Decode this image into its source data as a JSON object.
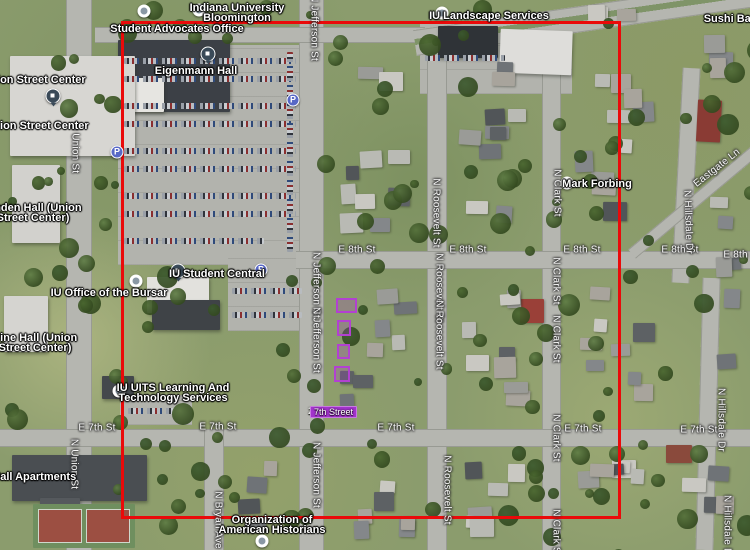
{
  "map": {
    "boundary": {
      "color": "#ea0a0a",
      "left": 121,
      "top": 21,
      "width": 500,
      "height": 498
    },
    "selection": {
      "color": "#b241d1",
      "parcels": [
        {
          "x": 336,
          "y": 298,
          "w": 21,
          "h": 15
        },
        {
          "x": 337,
          "y": 320,
          "w": 14,
          "h": 16
        },
        {
          "x": 337,
          "y": 344,
          "w": 13,
          "h": 15
        },
        {
          "x": 334,
          "y": 366,
          "w": 16,
          "h": 16
        }
      ],
      "label": {
        "prefix": "230",
        "text": "7th Street",
        "x": 308,
        "y": 406
      }
    },
    "parking_icons": [
      {
        "x": 293,
        "y": 100
      },
      {
        "x": 117,
        "y": 152
      },
      {
        "x": 261,
        "y": 270
      }
    ],
    "pois": [
      {
        "name": "indiana-university-bloomington",
        "lines": [
          "Indiana University",
          "Bloomington"
        ],
        "x": 237,
        "y": 3,
        "pin": {
          "x": 199,
          "y": 10,
          "type": "poi"
        }
      },
      {
        "name": "student-advocates-office",
        "lines": [
          "Student Advocates Office"
        ],
        "x": 177,
        "y": 24,
        "pin": {
          "x": 144,
          "y": 11,
          "type": "poi"
        }
      },
      {
        "name": "eigenmann-hall",
        "lines": [
          "Eigenmann Hall"
        ],
        "x": 196,
        "y": 66,
        "pin": {
          "x": 208,
          "y": 54,
          "type": "navy"
        }
      },
      {
        "name": "iu-landscape-services",
        "lines": [
          "IU Landscape Services"
        ],
        "x": 489,
        "y": 11,
        "pin": {
          "x": 442,
          "y": 13,
          "type": "poi"
        }
      },
      {
        "name": "sushi-bar-bloomington",
        "lines": [
          "Sushi Bar Bloom"
        ],
        "x": 748,
        "y": 14
      },
      {
        "name": "union-street-center-north",
        "lines": [
          "Union Street Center"
        ],
        "x": 34,
        "y": 75,
        "pin": {
          "x": 53,
          "y": 96,
          "type": "navy"
        }
      },
      {
        "name": "union-street-center-south",
        "lines": [
          "Union Street Center"
        ],
        "x": 37,
        "y": 121
      },
      {
        "name": "linden-hall-union-street-center",
        "lines": [
          "Linden Hall (Union",
          "Street Center)"
        ],
        "x": 33,
        "y": 203
      },
      {
        "name": "iu-office-of-the-bursar",
        "lines": [
          "IU Office of the Bursar"
        ],
        "x": 109,
        "y": 288,
        "pin": {
          "x": 136,
          "y": 281,
          "type": "poi"
        }
      },
      {
        "name": "pine-hall-union-street-center",
        "lines": [
          "Pine Hall (Union",
          "Street Center)"
        ],
        "x": 35,
        "y": 333
      },
      {
        "name": "iu-student-central",
        "lines": [
          "IU Student Central"
        ],
        "x": 217,
        "y": 269,
        "pin": {
          "x": 178,
          "y": 271,
          "type": "navy"
        }
      },
      {
        "name": "mark-forbing",
        "lines": [
          "Mark Forbing"
        ],
        "x": 597,
        "y": 179,
        "pin": {
          "x": 567,
          "y": 183,
          "type": "poi"
        }
      },
      {
        "name": "iu-uits-learning-and-technology-services",
        "lines": [
          "IU UITS Learning And",
          "Technology Services"
        ],
        "x": 173,
        "y": 383,
        "pin": {
          "x": 119,
          "y": 391,
          "type": "poi"
        }
      },
      {
        "name": "organization-of-american-historians",
        "lines": [
          "Organization of",
          "American Historians"
        ],
        "x": 272,
        "y": 515,
        "pin": {
          "x": 262,
          "y": 541,
          "type": "poi"
        }
      },
      {
        "name": "hall-apartments",
        "lines": [
          "on Hall Apartments"
        ],
        "x": 26,
        "y": 472
      }
    ],
    "streets": [
      {
        "label": "E 8th St",
        "x": 357,
        "y": 250,
        "rot": 0
      },
      {
        "label": "E 8th St",
        "x": 468,
        "y": 250,
        "rot": 0
      },
      {
        "label": "E 8th St",
        "x": 582,
        "y": 250,
        "rot": 0
      },
      {
        "label": "E 8th St",
        "x": 680,
        "y": 250,
        "rot": 0
      },
      {
        "label": "E 8th St",
        "x": 742,
        "y": 255,
        "rot": 0
      },
      {
        "label": "E 7th St",
        "x": 97,
        "y": 428,
        "rot": 0
      },
      {
        "label": "E 7th St",
        "x": 218,
        "y": 427,
        "rot": 0
      },
      {
        "label": "E 7th St",
        "x": 396,
        "y": 428,
        "rot": 0
      },
      {
        "label": "E 7th St",
        "x": 583,
        "y": 429,
        "rot": 0
      },
      {
        "label": "E 7th St",
        "x": 699,
        "y": 430,
        "rot": 0
      },
      {
        "label": "N Union St",
        "x": 75,
        "y": 148,
        "rot": 90
      },
      {
        "label": "N Union St",
        "x": 74,
        "y": 464,
        "rot": 90
      },
      {
        "label": "N Jefferson St",
        "x": 314,
        "y": 28,
        "rot": 90
      },
      {
        "label": "N Jefferson St",
        "x": 316,
        "y": 285,
        "rot": 90
      },
      {
        "label": "N Jefferson St",
        "x": 316,
        "y": 340,
        "rot": 90
      },
      {
        "label": "N Jefferson St",
        "x": 316,
        "y": 475,
        "rot": 90
      },
      {
        "label": "N Roosevelt St",
        "x": 436,
        "y": 213,
        "rot": 90
      },
      {
        "label": "N Roosevelt St",
        "x": 439,
        "y": 288,
        "rot": 90
      },
      {
        "label": "N Roosevelt St",
        "x": 439,
        "y": 335,
        "rot": 90
      },
      {
        "label": "N Roosevelt St",
        "x": 447,
        "y": 490,
        "rot": 90
      },
      {
        "label": "N Clark St",
        "x": 557,
        "y": 193,
        "rot": 90
      },
      {
        "label": "N Clark St",
        "x": 556,
        "y": 281,
        "rot": 90
      },
      {
        "label": "N Clark St",
        "x": 556,
        "y": 339,
        "rot": 90
      },
      {
        "label": "N Clark St",
        "x": 556,
        "y": 438,
        "rot": 90
      },
      {
        "label": "N Clark St",
        "x": 556,
        "y": 533,
        "rot": 90
      },
      {
        "label": "N Bryan Ave",
        "x": 218,
        "y": 520,
        "rot": 90
      },
      {
        "label": "N Hillsdale Dr",
        "x": 688,
        "y": 222,
        "rot": 88
      },
      {
        "label": "N Hillsdale Dr",
        "x": 721,
        "y": 420,
        "rot": 90
      },
      {
        "label": "N Hillsdale Dr",
        "x": 727,
        "y": 527,
        "rot": 90
      },
      {
        "label": "Eastgate Ln",
        "x": 717,
        "y": 168,
        "rot": -38
      }
    ]
  }
}
